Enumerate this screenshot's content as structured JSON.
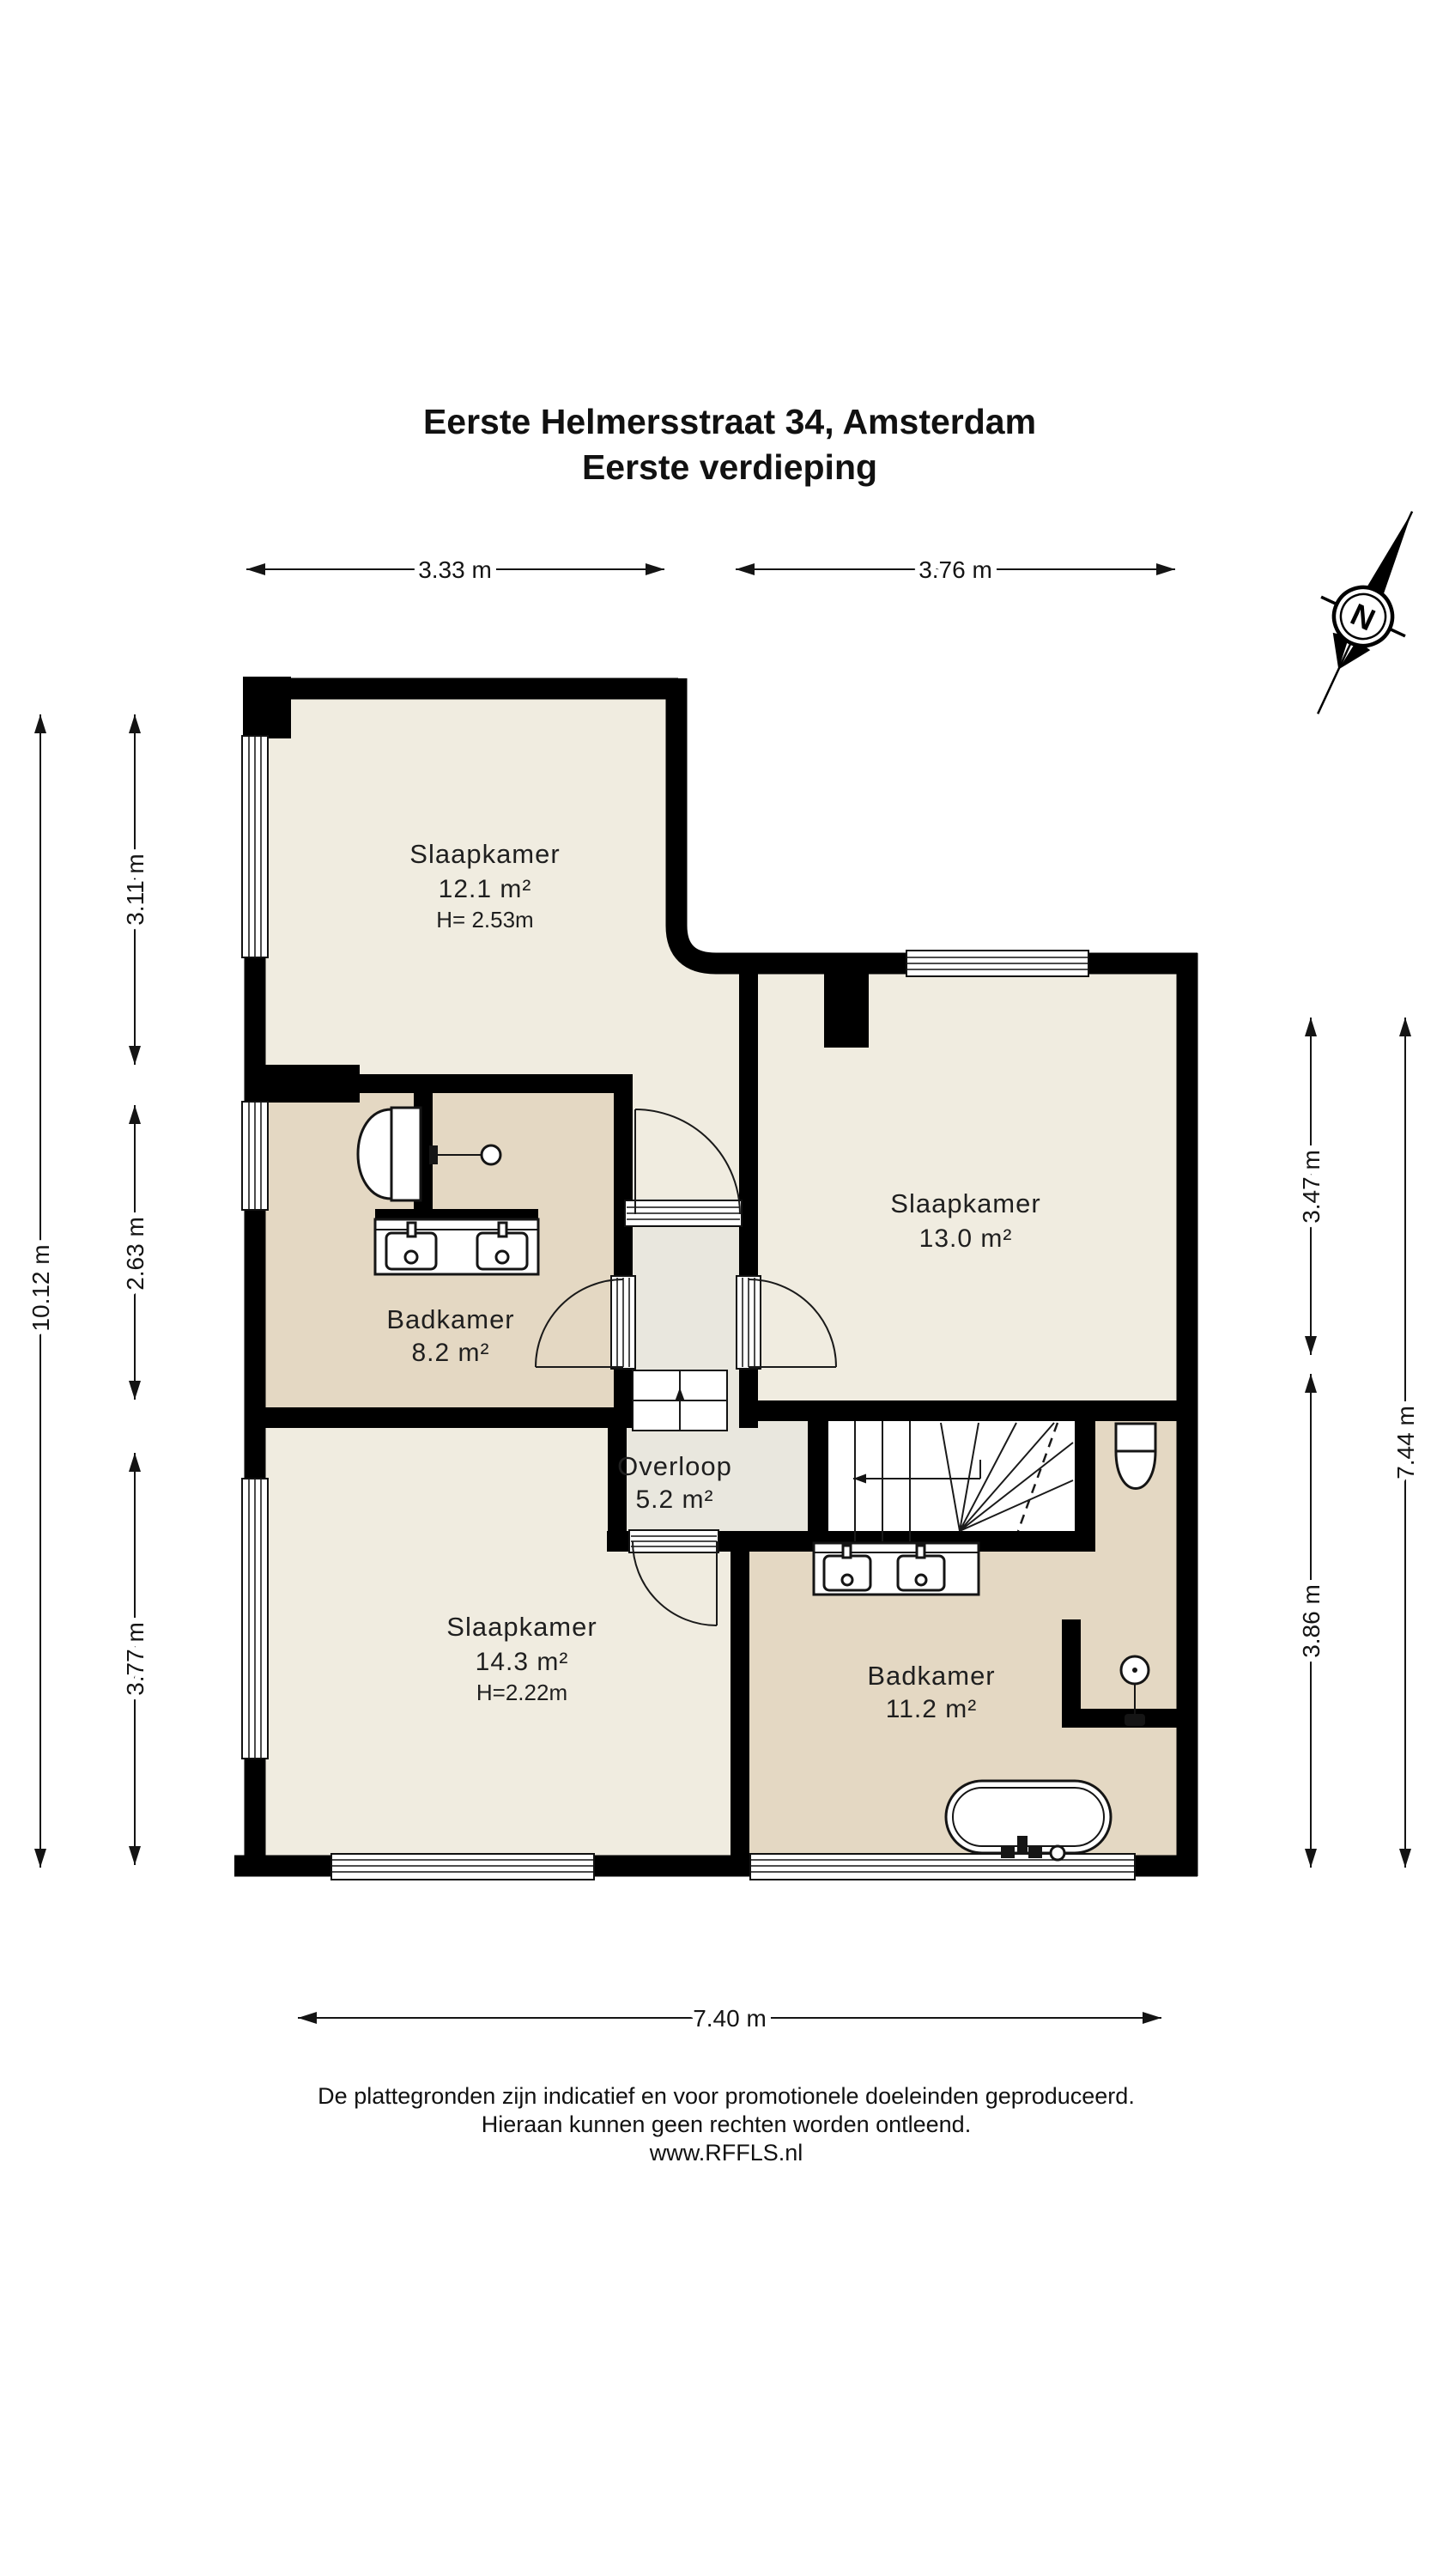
{
  "title": {
    "line1": "Eerste Helmersstraat 34, Amsterdam",
    "line2": "Eerste verdieping"
  },
  "compass": {
    "label": "N"
  },
  "rooms": {
    "slaapkamer_tl": {
      "name": "Slaapkamer",
      "area": "12.1 m²",
      "height": "H= 2.53m"
    },
    "slaapkamer_tr": {
      "name": "Slaapkamer",
      "area": "13.0 m²"
    },
    "badkamer_top": {
      "name": "Badkamer",
      "area": "8.2 m²"
    },
    "overloop": {
      "name": "Overloop",
      "area": "5.2 m²"
    },
    "slaapkamer_bl": {
      "name": "Slaapkamer",
      "area": "14.3 m²",
      "height": "H=2.22m"
    },
    "badkamer_bot": {
      "name": "Badkamer",
      "area": "11.2 m²"
    }
  },
  "dimensions": {
    "top_left": "3.33 m",
    "top_right": "3.76 m",
    "left_outer": "10.12 m",
    "left_1": "3.11 m",
    "left_2": "2.63 m",
    "left_3": "3.77 m",
    "right_1": "3.47 m",
    "right_2": "3.86 m",
    "right_outer": "7.44 m",
    "bottom": "7.40 m"
  },
  "footer": {
    "line1": "De plattegronden zijn indicatief en voor promotionele doeleinden geproduceerd.",
    "line2": "Hieraan kunnen geen rechten worden ontleend.",
    "line3": "www.RFFLS.nl"
  },
  "icons": {
    "compass": "north-arrow-icon",
    "toilet": "toilet-icon",
    "double_sink": "double-sink-icon",
    "bathtub": "bathtub-icon",
    "shower": "shower-icon",
    "stairs": "stairs-icon"
  },
  "colors": {
    "room": "#f0ece0",
    "bathroom": "#e4d8c3",
    "hall": "#e9e7de",
    "wall": "#000000"
  }
}
